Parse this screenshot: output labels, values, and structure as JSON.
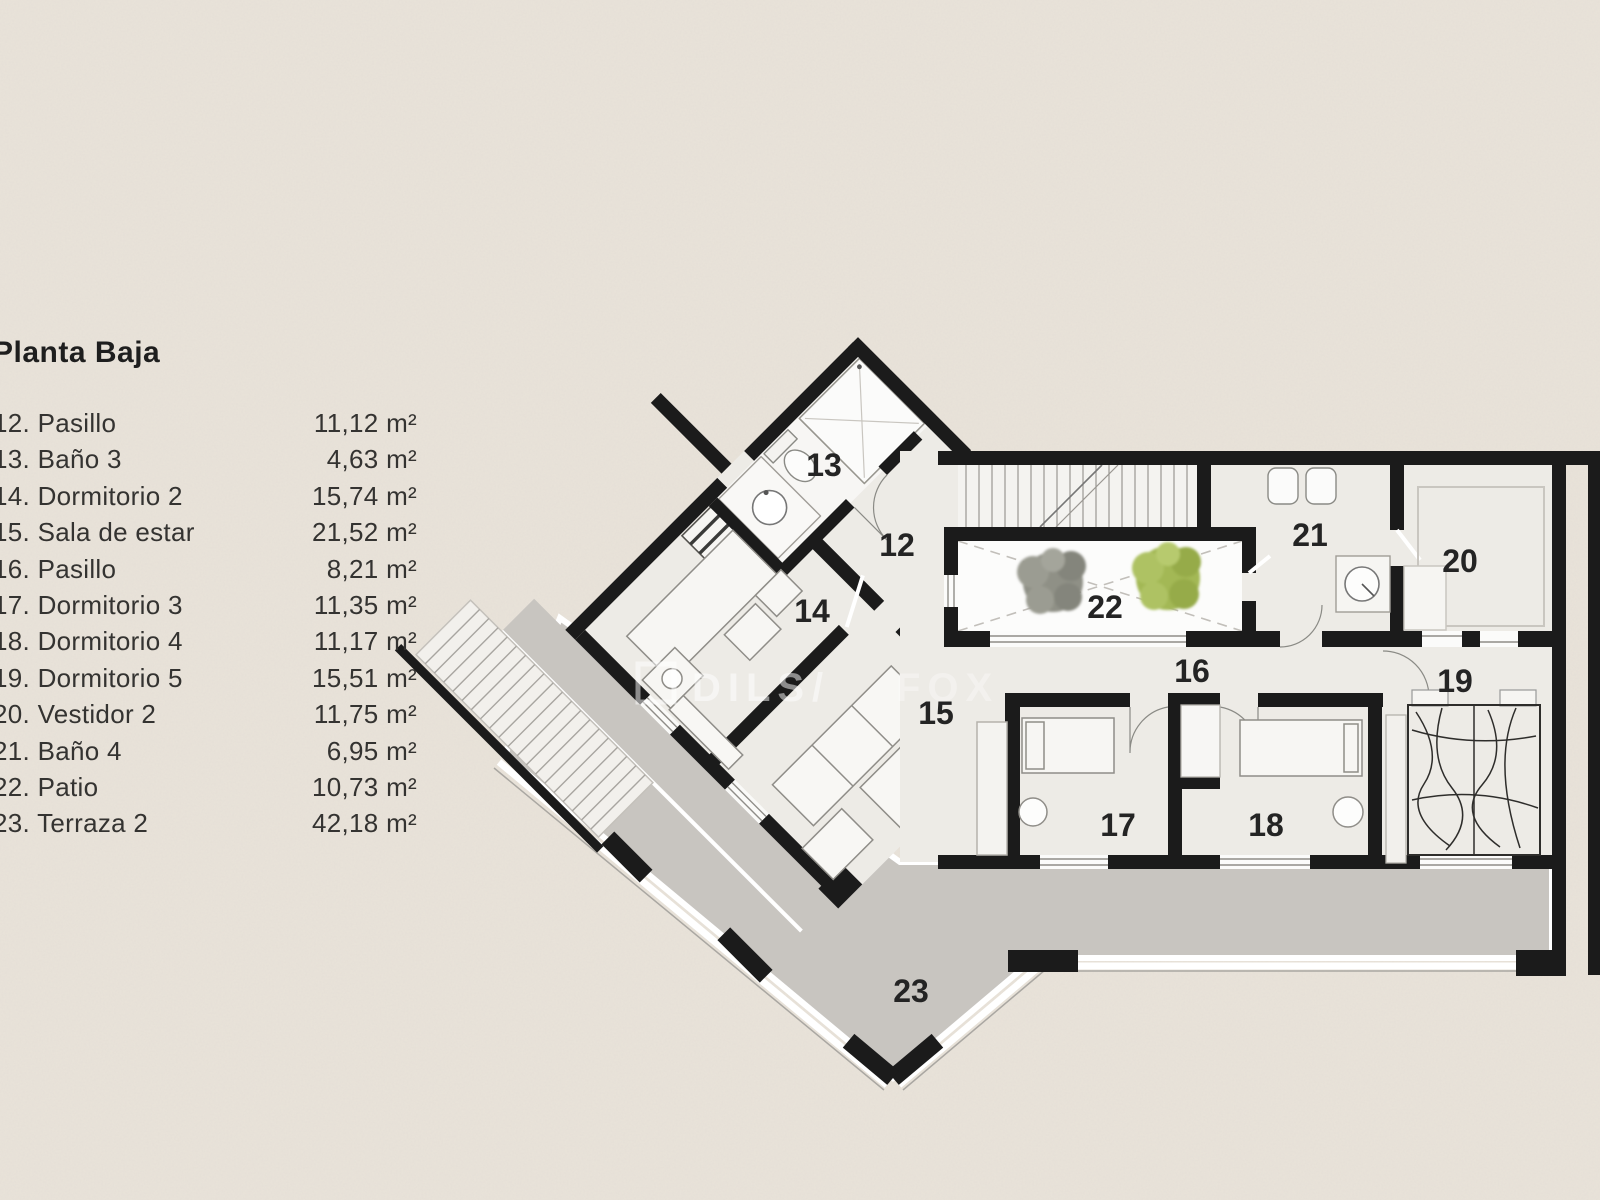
{
  "legend": {
    "title": "Planta Baja",
    "items": [
      {
        "label": "12. Pasillo",
        "area": "11,12 m²"
      },
      {
        "label": "13. Baño 3",
        "area": "4,63 m²"
      },
      {
        "label": "14. Dormitorio 2",
        "area": "15,74 m²"
      },
      {
        "label": "15. Sala de estar",
        "area": "21,52 m²"
      },
      {
        "label": "16. Pasillo",
        "area": "8,21 m²"
      },
      {
        "label": "17. Dormitorio 3",
        "area": "11,35 m²"
      },
      {
        "label": "18. Dormitorio 4",
        "area": "11,17 m²"
      },
      {
        "label": "19. Dormitorio 5",
        "area": "15,51 m²"
      },
      {
        "label": "20. Vestidor  2",
        "area": "11,75 m²"
      },
      {
        "label": "21. Baño 4",
        "area": "6,95 m²"
      },
      {
        "label": "22. Patio",
        "area": "10,73 m²"
      },
      {
        "label": "23. Terraza 2",
        "area": "42,18 m²"
      }
    ]
  },
  "plan": {
    "room_numbers": [
      "12",
      "13",
      "14",
      "15",
      "16",
      "17",
      "18",
      "19",
      "20",
      "21",
      "22",
      "23"
    ],
    "watermark": {
      "brand": "DILS",
      "separator": "/",
      "partner": "FOX"
    }
  },
  "colors": {
    "background": "#e9e3da",
    "wall": "#1b1b1b",
    "floor": "#edebe6",
    "terrace": "#c8c5c0",
    "patio": "#fcfcfb",
    "tree_green": "#a3b855",
    "tree_gray": "#8f9086"
  }
}
